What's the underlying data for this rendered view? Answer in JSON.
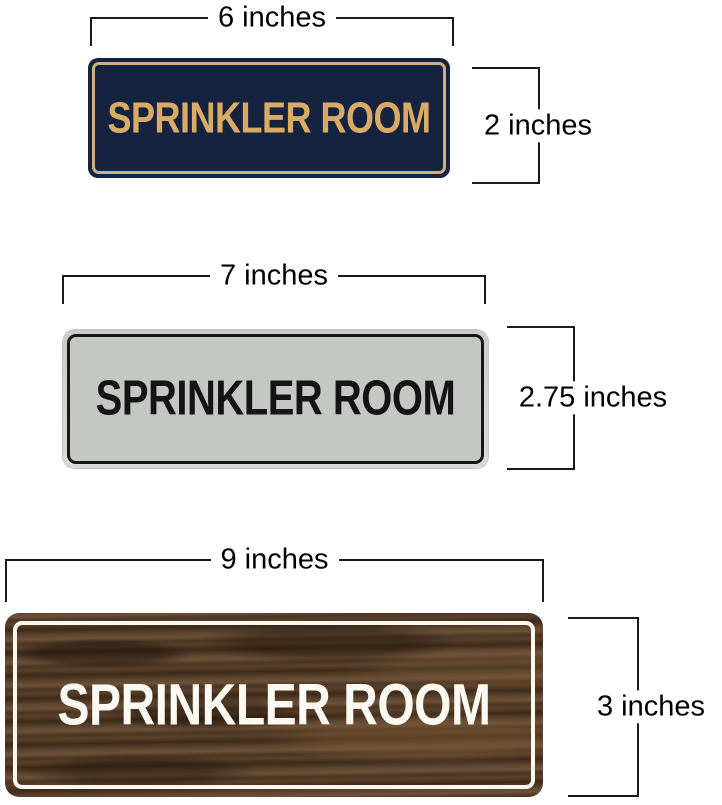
{
  "signs": [
    {
      "name": "navy-gold-sign",
      "text": "SPRINKLER ROOM",
      "width_label": "6 inches",
      "height_label": "2 inches",
      "colors": {
        "background": "#16233e",
        "inner_border": "#cdb086",
        "text": "#d9ab64"
      }
    },
    {
      "name": "silver-black-sign",
      "text": "SPRINKLER ROOM",
      "width_label": "7 inches",
      "height_label": "2.75 inches",
      "colors": {
        "background": "#c5c7c4",
        "rim": "#d3d4d2",
        "inner_border": "#161616",
        "text": "#141414"
      }
    },
    {
      "name": "walnut-wood-sign",
      "text": "SPRINKLER ROOM",
      "width_label": "9 inches",
      "height_label": "3 inches",
      "colors": {
        "wood_dark": "#3c2a1a",
        "wood_light": "#6d5138",
        "inner_border": "#faf8ee",
        "text": "#fbf9f2"
      }
    }
  ],
  "dimension_style": {
    "line_color": "#1a1a1a",
    "label_color": "#000000"
  }
}
